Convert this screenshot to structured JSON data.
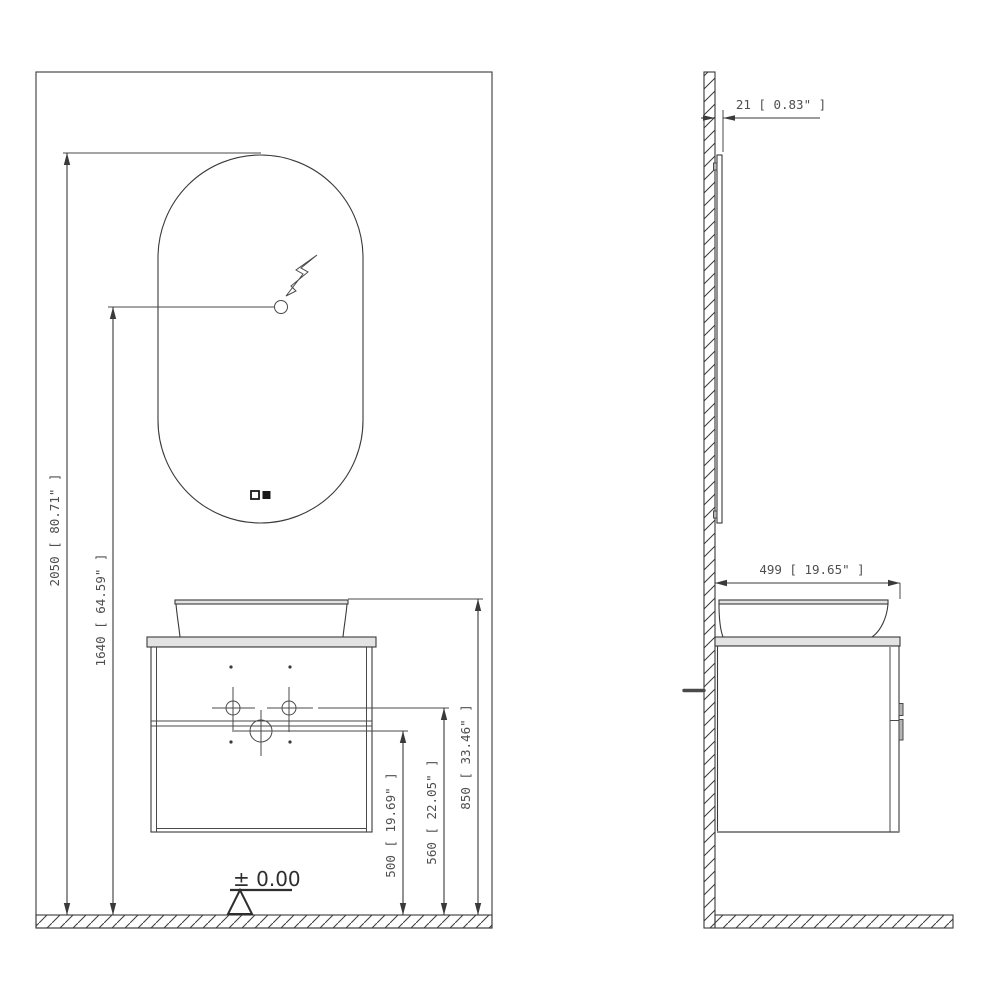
{
  "drawing": {
    "type": "technical-installation-drawing",
    "subject": "wall-mounted bathroom vanity with oval LED mirror and vessel sink",
    "views": {
      "left": "front elevation",
      "right": "side elevation"
    }
  },
  "dimensions": {
    "total_height": "2050 [ 80.71\" ]",
    "switch_height": "1640 [ 64.59\" ]",
    "drain_height": "500 [ 19.69\" ]",
    "inlet_height": "560 [ 22.05\" ]",
    "counter_height": "850 [ 33.46\" ]",
    "mirror_thickness": "21 [ 0.83\" ]",
    "cabinet_depth": "499 [ 19.65\" ]",
    "floor_datum": "± 0.00"
  },
  "icons": {
    "power_connection": "lightning-bolt-arrow",
    "touch_sensor": "small-circle",
    "mirror_buttons": "outline-square-and-filled-square",
    "datum_marker": "open-triangle",
    "wall_floor": "diagonal-hatch"
  },
  "colors": {
    "background": "#ffffff",
    "line": "#3a3a3a",
    "text": "#4f4f4f",
    "light_fill": "#e3e3e3",
    "gray_fill": "#b5b5b5"
  }
}
